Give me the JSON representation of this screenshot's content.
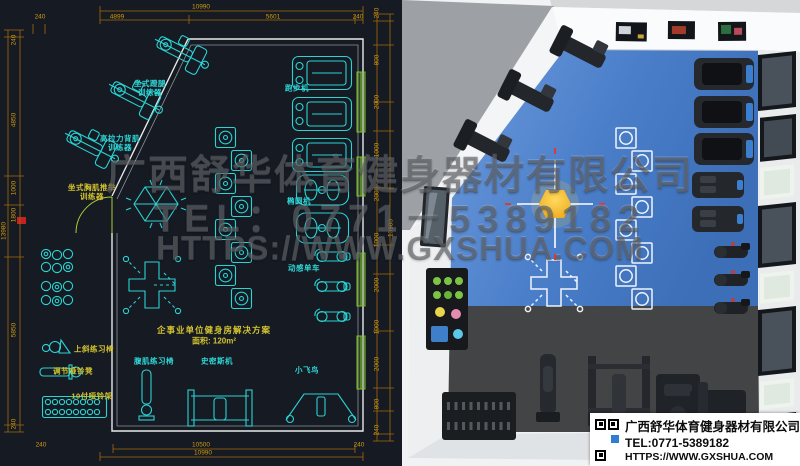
{
  "watermark": {
    "company": "广西舒华体育健身器材有限公司",
    "tel": "TEL：0771－5389182",
    "url": "HTTPS://WWW.GXSHUA.COM"
  },
  "plan": {
    "title": "企事业单位健身房解决方案",
    "area": "面积: 120m²",
    "labels": [
      {
        "text": "坐式蹬腿\n训练器",
        "tone": "cyan"
      },
      {
        "text": "高拉力背肌\n训练器",
        "tone": "cyan"
      },
      {
        "text": "坐式胸肌推举\n训练器",
        "tone": "yellow"
      },
      {
        "text": "跑步机",
        "tone": "cyan"
      },
      {
        "text": "椭圆机",
        "tone": "cyan"
      },
      {
        "text": "动感单车",
        "tone": "cyan"
      },
      {
        "text": "上斜练习椅",
        "tone": "yellow"
      },
      {
        "text": "调节哑铃凳",
        "tone": "yellow"
      },
      {
        "text": "10付哑铃架",
        "tone": "yellow"
      },
      {
        "text": "腹肌练习椅",
        "tone": "cyan"
      },
      {
        "text": "史密斯机",
        "tone": "cyan"
      },
      {
        "text": "小飞鸟",
        "tone": "cyan"
      }
    ],
    "dims": {
      "top_total": "10990",
      "top_240_l": "240",
      "top_seg1": "4899",
      "top_seg2": "5601",
      "top_240_r": "240",
      "bottom_inner": "10500",
      "bottom_total": "10990",
      "bottom_240_l": "240",
      "bottom_240_r": "240",
      "left_total": "13980",
      "left_segs": [
        "240",
        "4850",
        "1000",
        "1800",
        "5850",
        "240"
      ],
      "right_total": "13980",
      "right_segs": [
        "240",
        "800",
        "2000",
        "1000",
        "2000",
        "1000",
        "2000",
        "1000",
        "2000",
        "800",
        "240"
      ]
    }
  },
  "infobox": {
    "company": "广西舒华体育健身器材有限公司",
    "tel": "TEL:0771-5389182",
    "url": "HTTPS://WWW.GXSHUA.COM"
  },
  "colors": {
    "cad_background": "#151a23",
    "cad_line_cyan": "#2bd3d3",
    "cad_label_yellow": "#d4c430",
    "dimension_line": "#a36a08",
    "dimension_text": "#cf9a10",
    "window_green": "#7dc22c",
    "door_green": "#a9cf32",
    "floor_blue": "#4a7ec9",
    "floor_dark": "#47494b",
    "light_yellow": "#f2b51d",
    "watermark_gray": "#50545a"
  }
}
